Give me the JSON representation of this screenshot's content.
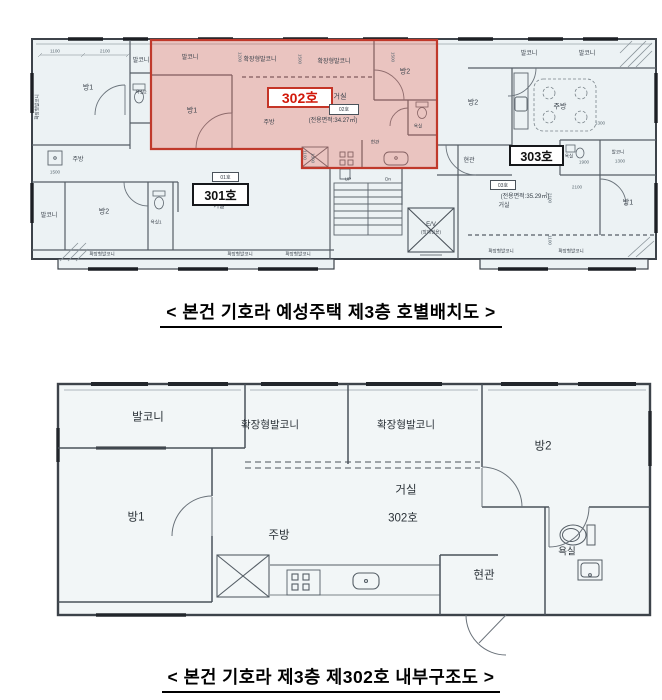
{
  "captions": {
    "plan1": "< 본건 기호라 예성주택 제3층 호별배치도 >",
    "plan2": "< 본건 기호라 제3층 제302호 내부구조도 >"
  },
  "labels": {
    "balcony": "발코니",
    "ext_balcony": "확장형발코니",
    "room1": "방1",
    "room2": "방2",
    "living": "거실",
    "kitchen": "주방",
    "bath": "욕실",
    "bath1": "욕실1",
    "bath2": "욕실2",
    "entrance": "현관",
    "up": "UP",
    "dn": "Dn",
    "elevator": "E/V",
    "elevator_note": "(장애인용)",
    "unit302_room": "302호"
  },
  "units": {
    "u301": {
      "badge": "301호",
      "tag": "01호"
    },
    "u302": {
      "badge": "302호",
      "tag": "02호",
      "area": "(전용면적:34.27㎡)"
    },
    "u303": {
      "badge": "303호",
      "tag": "03호",
      "area": "(전용면적:35.29㎡)"
    }
  },
  "dims": {
    "d1100": "1100",
    "d1200": "1200",
    "d1300": "1300",
    "d1500": "1500",
    "d1900": "1900",
    "d2100": "2100"
  },
  "colors": {
    "highlight_fill": "#e4584a",
    "highlight_border": "#c0392b",
    "unit_number_red": "#d2190a",
    "wall": "#3d434a",
    "paper": "#ecf2f4"
  }
}
